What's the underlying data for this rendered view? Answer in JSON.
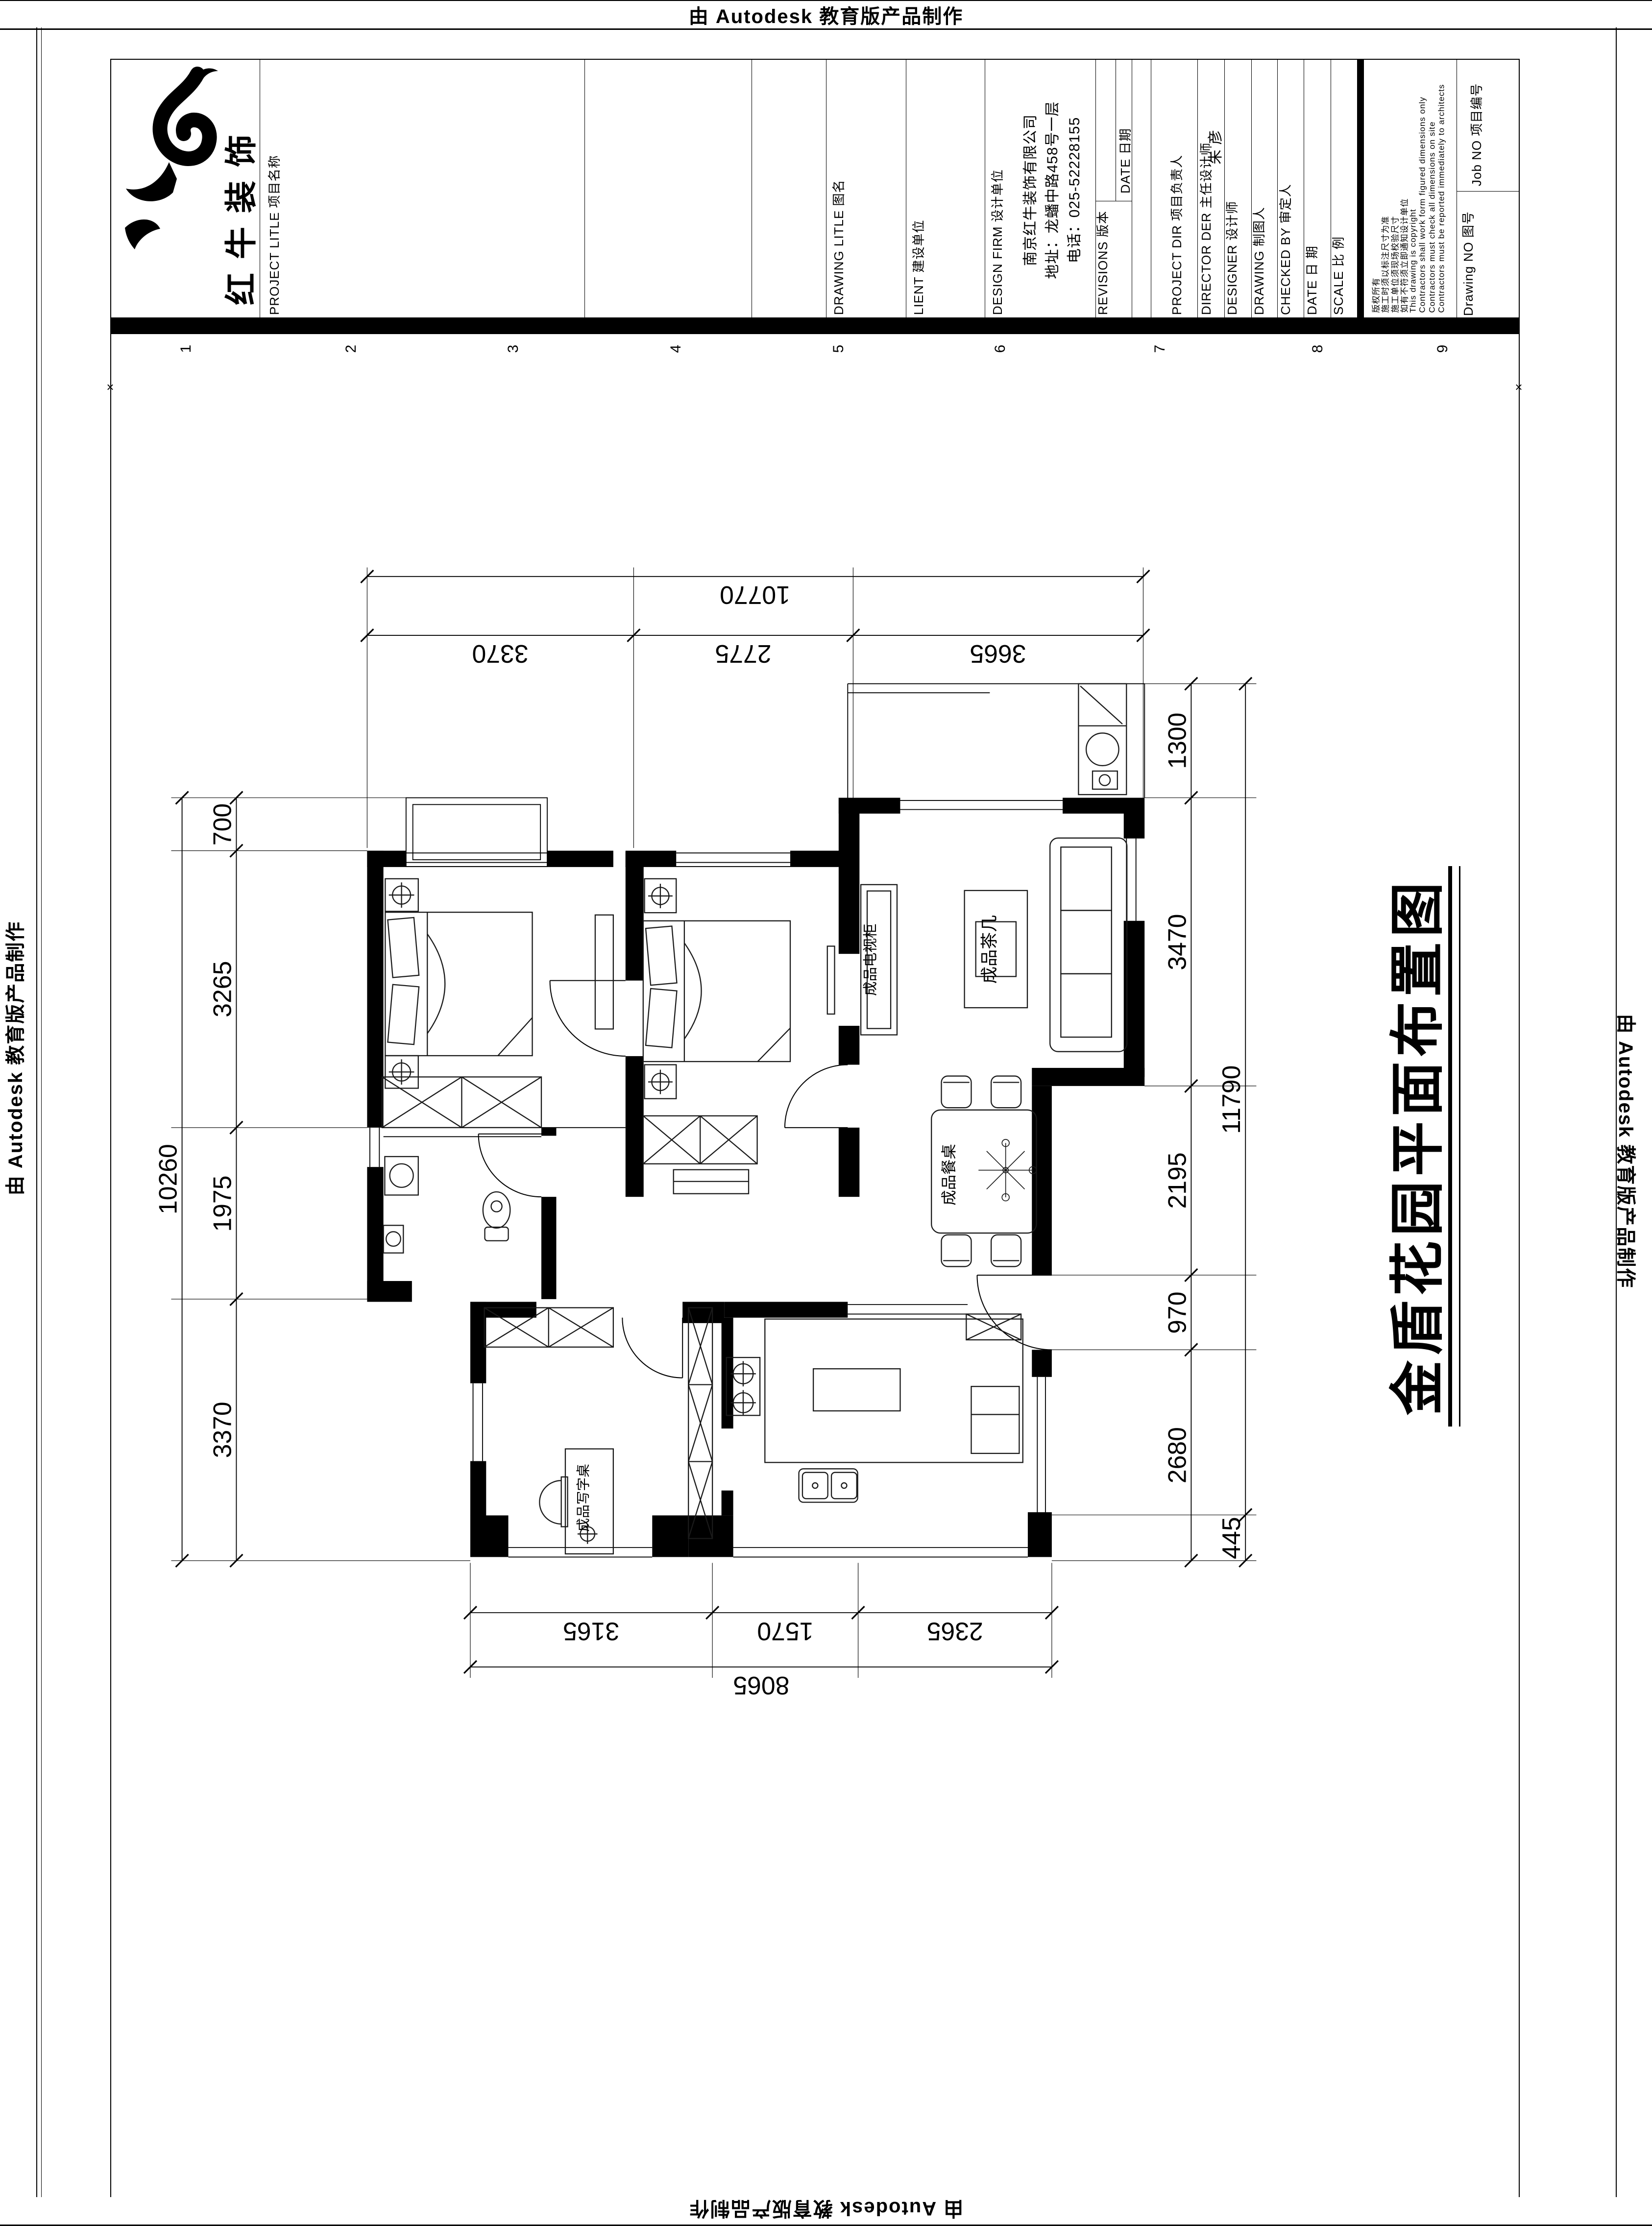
{
  "edge_banner": {
    "text": "由 Autodesk 教育版产品制作"
  },
  "drawing_title": "金盾花园平面布置图",
  "title_block": {
    "logo_name": "红牛装饰",
    "project_title_label": "PROJECT LITLE 项目名称",
    "drawing_title_label": "DRAWING LITLE 图名",
    "client_label": "LIENT 建设单位",
    "design_firm_label": "DESIGN FIRM 设计单位",
    "design_firm_lines": [
      "南京红牛装饰有限公司",
      "地址：龙蟠中路458号一层",
      "电话：025-52228155"
    ],
    "revisions_label": "REVISIONS 版本",
    "date_col_label": "DATE 日期",
    "project_dir_label": "PROJECT DIR 项目负责人",
    "director_label": "DIRECTOR DER 主任设计师",
    "director_value": "朱  彦",
    "designer_label": "DESIGNER 设计师",
    "drawing_by_label": "DRAWING 制图人",
    "checked_by_label": "CHECKED BY 审定人",
    "date_label": "DATE 日  期",
    "scale_label": "SCALE 比  例",
    "job_no_label": "Job NO 项目编号",
    "drawing_no_label": "Drawing NO 图号",
    "copyright_lines": [
      "版权所有",
      "施工时须以标注尺寸为准",
      "施工单位须现场校验尺寸",
      "如有不符须立即通知设计单位",
      "This drawing is copyright",
      "Contractors shall work form figured dimensions only",
      "Contractors must check all dimensions on site",
      "Contractors must be reported immediately to architects"
    ],
    "grid_numbers": [
      "1",
      "2",
      "3",
      "4",
      "5",
      "6",
      "7",
      "8",
      "9"
    ]
  },
  "plan": {
    "labels": {
      "tv_cabinet": "成品电视柜",
      "coffee_table": "成品茶几",
      "dining_table": "成品餐桌",
      "desk": "成品写字桌"
    },
    "dims": {
      "top": {
        "total": "10770",
        "segments": [
          "3370",
          "2775",
          "3665"
        ]
      },
      "bottom": {
        "total": "8065",
        "segments": [
          "3165",
          "1570",
          "2365"
        ]
      },
      "left": {
        "total": "10260",
        "segments": [
          "700",
          "3265",
          "1975",
          "3370"
        ]
      },
      "right": {
        "totals": [
          "11790",
          "445"
        ],
        "segments": [
          "1300",
          "3470",
          "2195",
          "970",
          "2680"
        ]
      }
    }
  }
}
